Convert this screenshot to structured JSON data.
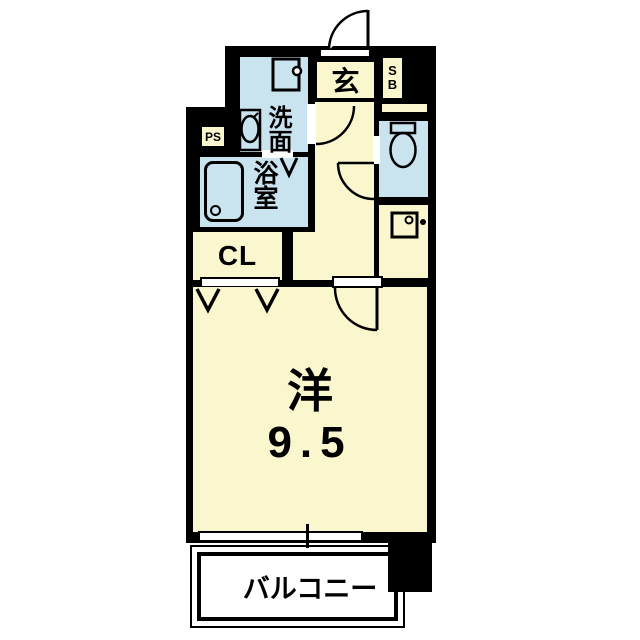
{
  "floorplan": {
    "type": "japanese-apartment-floor-plan",
    "rooms": {
      "entrance": {
        "label": "玄"
      },
      "shoe_box": {
        "line1": "S",
        "line2": "B"
      },
      "pipe_space": {
        "label": "PS"
      },
      "washroom": {
        "label": "洗面"
      },
      "bathroom": {
        "label": "浴室"
      },
      "closet": {
        "label": "CL"
      },
      "western_room": {
        "label": "洋",
        "size": "9.5"
      },
      "balcony": {
        "label": "バルコニー"
      }
    },
    "colors": {
      "wall": "#000000",
      "room_fill": "#faf7ce",
      "wet_area_fill": "#c9e3ef",
      "balcony_fill": "#ffffff",
      "line": "#000000"
    },
    "icons": [
      "entrance-door-arc-icon",
      "washing-machine-pan-icon",
      "washbasin-icon",
      "bathtub-icon",
      "toilet-icon",
      "sink-icon",
      "washroom-door-arc-icon",
      "toilet-door-arc-icon",
      "room-door-arc-icon",
      "folding-door-icon",
      "bath-door-mark-icon",
      "sliding-window-icon"
    ]
  }
}
